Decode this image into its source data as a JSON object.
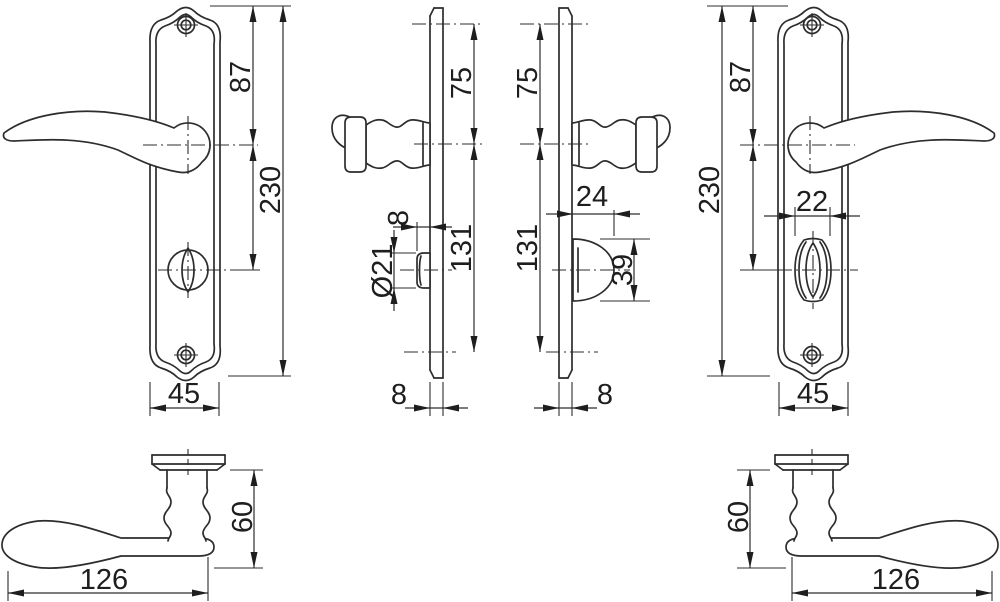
{
  "drawing_title": "Door handle set technical drawing",
  "views": {
    "front_left": {
      "top_offset": "87",
      "height": "230",
      "width": "45"
    },
    "side_left": {
      "upper": "75",
      "lower": "131",
      "knob_depth": "8",
      "knob_diameter": "Ø21",
      "plate_thickness": "8"
    },
    "side_right": {
      "upper": "75",
      "lower": "131",
      "turn_depth": "24",
      "turn_height": "39",
      "plate_thickness": "8"
    },
    "front_right": {
      "top_offset": "87",
      "height": "230",
      "turn_width": "22",
      "width": "45"
    },
    "handle_top_left": {
      "height": "60",
      "length": "126"
    },
    "handle_top_right": {
      "height": "60",
      "length": "126"
    }
  }
}
